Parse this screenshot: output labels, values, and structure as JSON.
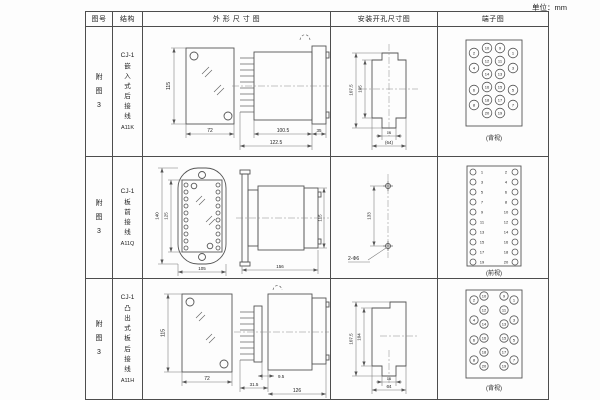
{
  "unit_label": "单位：mm",
  "table": {
    "headers": {
      "fig_no": "图号",
      "structure": "结构",
      "outline": "外 形 尺 寸 图",
      "mounting": "安装开孔尺寸图",
      "terminal": "端子图"
    },
    "rows": [
      {
        "fig_no": "附图3",
        "model": "CJ-1",
        "desc": "嵌入式后接线",
        "code": "A11K",
        "outline": {
          "front_h": "115",
          "front_w": "72",
          "side_d1": "100.5",
          "side_d2": "122.5",
          "side_d3": "35"
        },
        "mounting": {
          "d1": "107.5",
          "d2": "105",
          "d3": "16",
          "d4": "(64)"
        },
        "terminal": {
          "view": "(背视)",
          "ol": [
            "2",
            "4",
            "6",
            "8"
          ],
          "ml": [
            "10",
            "12",
            "14",
            "16",
            "18",
            "20"
          ],
          "mr": [
            "9",
            "11",
            "13",
            "15",
            "17",
            "19"
          ],
          "or": [
            "1",
            "3",
            "5",
            "7"
          ]
        }
      },
      {
        "fig_no": "附图3",
        "model": "CJ-1",
        "desc": "板前接线",
        "code": "A11Q",
        "outline": {
          "front_h1": "140",
          "front_h2": "125",
          "front_w": "105",
          "side_len": "156",
          "side_h": "115"
        },
        "mounting": {
          "d1": "133",
          "holes": "2-Φ6"
        },
        "terminal": {
          "view": "(前视)",
          "lc": [
            "1",
            "3",
            "5",
            "7",
            "9",
            "11",
            "13",
            "15",
            "17",
            "19"
          ],
          "rc": [
            "2",
            "4",
            "6",
            "8",
            "10",
            "12",
            "14",
            "16",
            "18",
            "20"
          ]
        }
      },
      {
        "fig_no": "附图3",
        "model": "CJ-1",
        "desc": "凸出式板后接线",
        "code": "A11H",
        "outline": {
          "front_h": "115",
          "front_w": "72",
          "side_d1": "9.5",
          "side_d2": "31.5",
          "side_d3": "126"
        },
        "mounting": {
          "d1": "107.5",
          "d2": "104",
          "d3": "16",
          "d4": "64"
        },
        "terminal": {
          "view": "(背视)",
          "ol": [
            "2",
            "4",
            "6",
            "8"
          ],
          "ml": [
            "10",
            "12",
            "14",
            "16",
            "18",
            "20"
          ],
          "mr": [
            "9",
            "11",
            "13",
            "15",
            "17",
            "19"
          ],
          "or": [
            "1",
            "3",
            "5",
            "7"
          ]
        }
      }
    ]
  }
}
